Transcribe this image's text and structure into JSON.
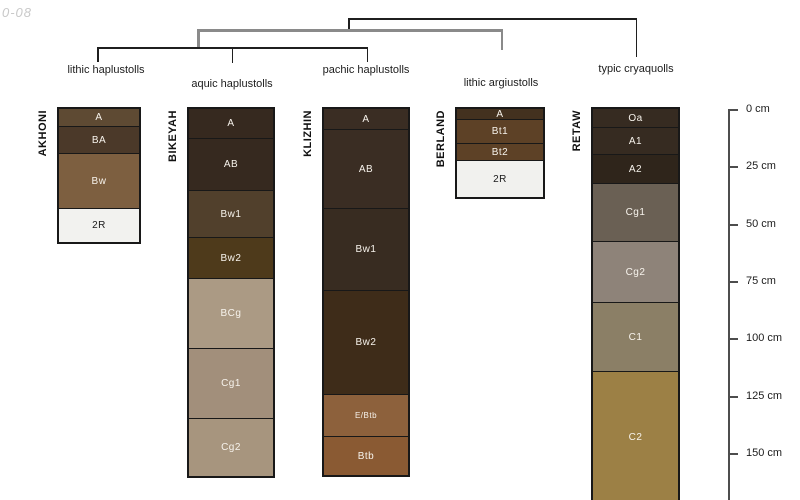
{
  "watermark": "0-08",
  "figure": {
    "width": 800,
    "height": 500,
    "background": "#ffffff"
  },
  "palette": {
    "line_dark": "#1f1f1f",
    "line_gray": "#8a8a8a",
    "axis": "#4d4d4d",
    "watermark_color": "#c9c9c9",
    "horizon_border": "#181818",
    "label_light": "#f7f3ec",
    "label_dark": "#1a1a1a"
  },
  "classification_tree": {
    "labels": [
      {
        "text": "lithic haplustolls",
        "cx": 106,
        "top": 64
      },
      {
        "text": "aquic haplustolls",
        "cx": 232,
        "top": 78
      },
      {
        "text": "pachic haplustolls",
        "cx": 366,
        "top": 64
      },
      {
        "text": "lithic argiustolls",
        "cx": 501,
        "top": 77
      },
      {
        "text": "typic cryaquolls",
        "cx": 636,
        "top": 63
      }
    ],
    "segments": [
      {
        "x": 348,
        "y": 18,
        "w": 289,
        "h": 1.5,
        "tone": "dark"
      },
      {
        "x": 348,
        "y": 18,
        "w": 1.5,
        "h": 13,
        "tone": "dark"
      },
      {
        "x": 635.5,
        "y": 18,
        "w": 1.5,
        "h": 39,
        "tone": "dark"
      },
      {
        "x": 197,
        "y": 29,
        "w": 306,
        "h": 3,
        "tone": "gray"
      },
      {
        "x": 197,
        "y": 29,
        "w": 2.5,
        "h": 19,
        "tone": "gray"
      },
      {
        "x": 500.5,
        "y": 29,
        "w": 2.5,
        "h": 21,
        "tone": "gray"
      },
      {
        "x": 97,
        "y": 47,
        "w": 271,
        "h": 1.5,
        "tone": "dark"
      },
      {
        "x": 97,
        "y": 47,
        "w": 1.5,
        "h": 15,
        "tone": "dark"
      },
      {
        "x": 231.5,
        "y": 47,
        "w": 1.5,
        "h": 16,
        "tone": "dark"
      },
      {
        "x": 366.5,
        "y": 47,
        "w": 1.5,
        "h": 15,
        "tone": "dark"
      }
    ]
  },
  "depth_axis": {
    "x": 728,
    "top_y": 109,
    "bottom_y": 500,
    "px_per_cm": 2.2933,
    "tick_len": 10,
    "label_x": 746,
    "ticks": [
      {
        "cm": 0,
        "label": "0 cm"
      },
      {
        "cm": 25,
        "label": "25 cm"
      },
      {
        "cm": 50,
        "label": "50 cm"
      },
      {
        "cm": 75,
        "label": "75 cm"
      },
      {
        "cm": 100,
        "label": "100 cm"
      },
      {
        "cm": 125,
        "label": "125 cm"
      },
      {
        "cm": 150,
        "label": "150 cm"
      }
    ]
  },
  "profiles": [
    {
      "series": "AKHONI",
      "classification": "lithic haplustolls",
      "left": 57,
      "width": 84,
      "horizons": [
        {
          "label": "A",
          "top_cm": 0,
          "bottom_cm": 7.5,
          "color": "#5e4a33",
          "text": "light"
        },
        {
          "label": "BA",
          "top_cm": 7.5,
          "bottom_cm": 19.2,
          "color": "#4b3929",
          "text": "light"
        },
        {
          "label": "Bw",
          "top_cm": 19.2,
          "bottom_cm": 43.2,
          "color": "#7d5f40",
          "text": "light"
        },
        {
          "label": "2R",
          "top_cm": 43.2,
          "bottom_cm": 58.0,
          "color": "#f2f2ef",
          "text": "dark"
        }
      ]
    },
    {
      "series": "BIKEYAH",
      "classification": "aquic haplustolls",
      "left": 187,
      "width": 88,
      "horizons": [
        {
          "label": "A",
          "top_cm": 0,
          "bottom_cm": 12.6,
          "color": "#36291f",
          "text": "light"
        },
        {
          "label": "AB",
          "top_cm": 12.6,
          "bottom_cm": 35.5,
          "color": "#36291f",
          "text": "light"
        },
        {
          "label": "Bw1",
          "top_cm": 35.5,
          "bottom_cm": 56.0,
          "color": "#51402c",
          "text": "light"
        },
        {
          "label": "Bw2",
          "top_cm": 56.0,
          "bottom_cm": 73.7,
          "color": "#4e3a1b",
          "text": "light"
        },
        {
          "label": "BCg",
          "top_cm": 73.7,
          "bottom_cm": 104.2,
          "color": "#ab9a84",
          "text": "light"
        },
        {
          "label": "Cg1",
          "top_cm": 104.2,
          "bottom_cm": 134.8,
          "color": "#a28f7b",
          "text": "light"
        },
        {
          "label": "Cg2",
          "top_cm": 134.8,
          "bottom_cm": 160.0,
          "color": "#a7957e",
          "text": "light"
        }
      ]
    },
    {
      "series": "KLIZHIN",
      "classification": "pachic haplustolls",
      "left": 322,
      "width": 88,
      "horizons": [
        {
          "label": "A",
          "top_cm": 0,
          "bottom_cm": 8.7,
          "color": "#3a2d23",
          "text": "light"
        },
        {
          "label": "AB",
          "top_cm": 8.7,
          "bottom_cm": 43.2,
          "color": "#3a2d23",
          "text": "light"
        },
        {
          "label": "Bw1",
          "top_cm": 43.2,
          "bottom_cm": 78.9,
          "color": "#382c21",
          "text": "light"
        },
        {
          "label": "Bw2",
          "top_cm": 78.9,
          "bottom_cm": 124.3,
          "color": "#3e2c19",
          "text": "light"
        },
        {
          "label": "E/Btb",
          "top_cm": 124.3,
          "bottom_cm": 142.6,
          "color": "#8d613c",
          "text": "light",
          "small": true
        },
        {
          "label": "Btb",
          "top_cm": 142.6,
          "bottom_cm": 159.6,
          "color": "#8a5a33",
          "text": "light"
        }
      ]
    },
    {
      "series": "BERLAND",
      "classification": "lithic argiustolls",
      "left": 455,
      "width": 90,
      "horizons": [
        {
          "label": "A",
          "top_cm": 0,
          "bottom_cm": 4.4,
          "color": "#43311f",
          "text": "light"
        },
        {
          "label": "Bt1",
          "top_cm": 4.4,
          "bottom_cm": 14.8,
          "color": "#5d4126",
          "text": "light"
        },
        {
          "label": "Bt2",
          "top_cm": 14.8,
          "bottom_cm": 22.2,
          "color": "#5d4126",
          "text": "light"
        },
        {
          "label": "2R",
          "top_cm": 22.2,
          "bottom_cm": 38.5,
          "color": "#f1f1ee",
          "text": "dark"
        }
      ]
    },
    {
      "series": "RETAW",
      "classification": "typic cryaquolls",
      "left": 591,
      "width": 89,
      "horizons": [
        {
          "label": "Oa",
          "top_cm": 0,
          "bottom_cm": 7.9,
          "color": "#362b21",
          "text": "light"
        },
        {
          "label": "A1",
          "top_cm": 7.9,
          "bottom_cm": 19.6,
          "color": "#362b21",
          "text": "light"
        },
        {
          "label": "A2",
          "top_cm": 19.6,
          "bottom_cm": 32.3,
          "color": "#2f251b",
          "text": "light"
        },
        {
          "label": "Cg1",
          "top_cm": 32.3,
          "bottom_cm": 57.6,
          "color": "#6a6054",
          "text": "light"
        },
        {
          "label": "Cg2",
          "top_cm": 57.6,
          "bottom_cm": 84.2,
          "color": "#8e8379",
          "text": "light"
        },
        {
          "label": "C1",
          "top_cm": 84.2,
          "bottom_cm": 114.3,
          "color": "#8b7f66",
          "text": "light"
        },
        {
          "label": "C2",
          "top_cm": 114.3,
          "bottom_cm": 172.0,
          "color": "#9c8045",
          "text": "light"
        }
      ]
    }
  ]
}
